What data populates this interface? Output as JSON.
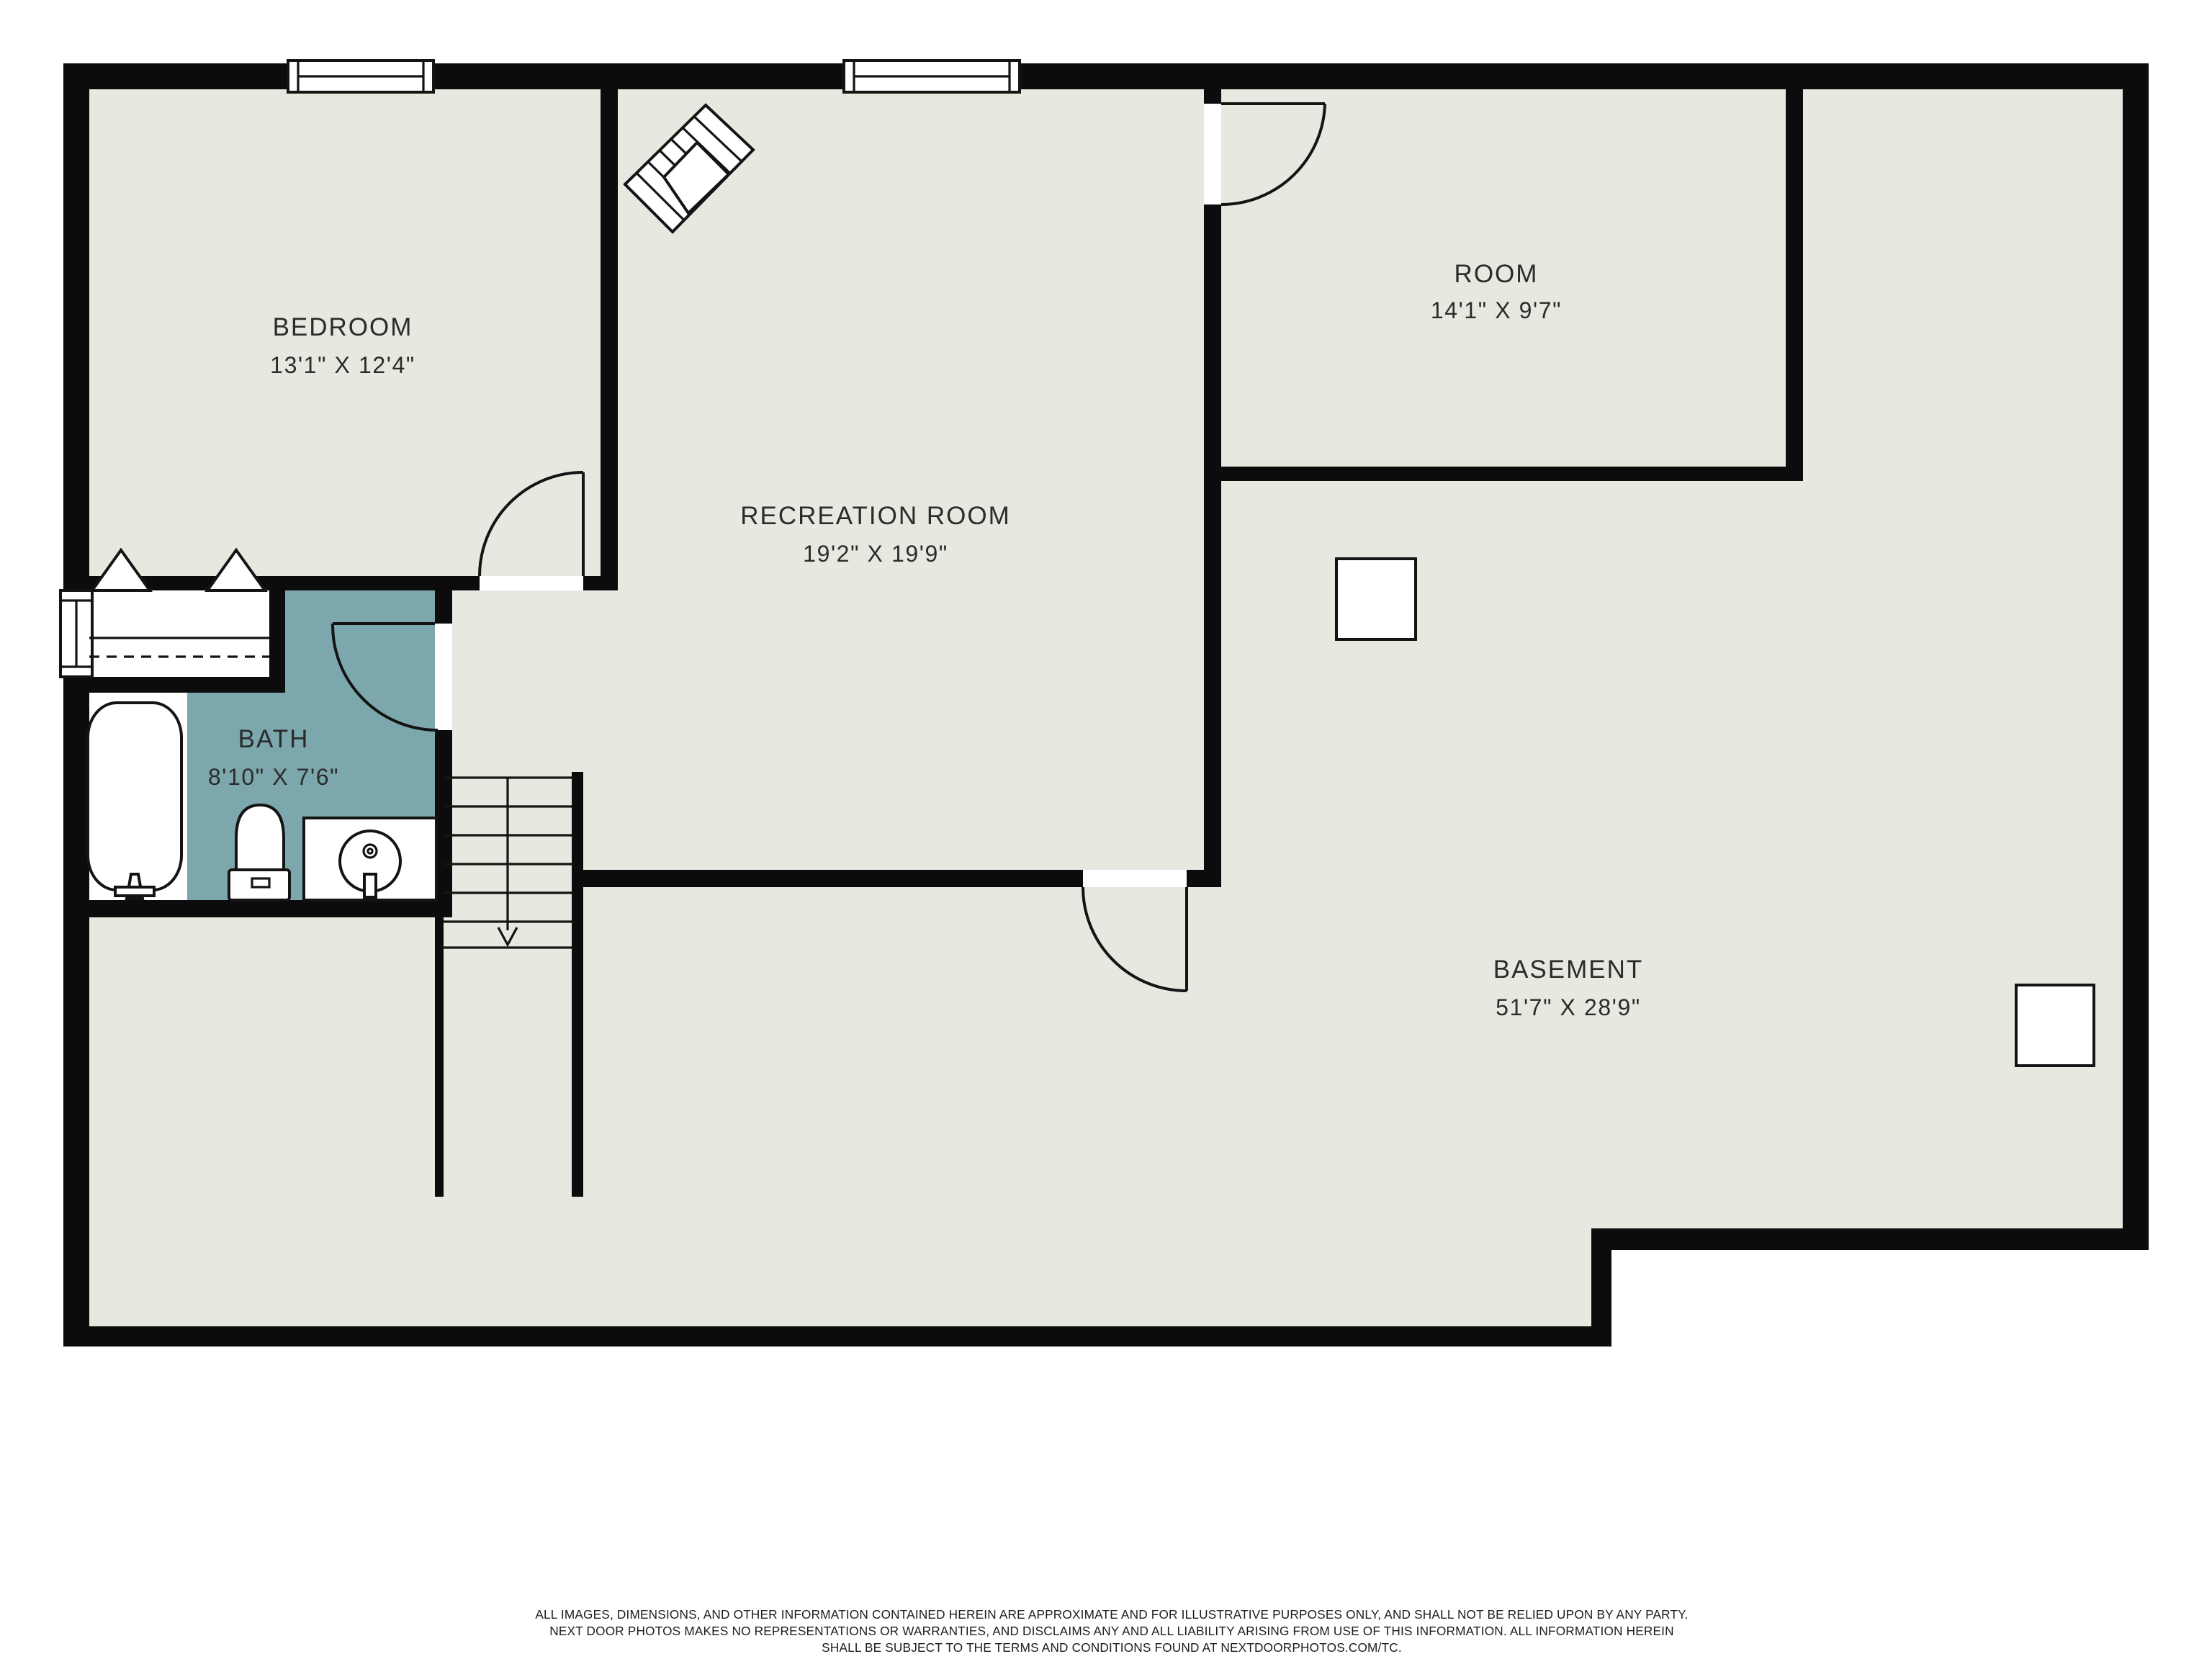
{
  "plan": {
    "rooms": [
      {
        "name": "BEDROOM",
        "dims": "13'1\" X 12'4\""
      },
      {
        "name": "RECREATION ROOM",
        "dims": "19'2\" X 19'9\""
      },
      {
        "name": "ROOM",
        "dims": "14'1\" X 9'7\""
      },
      {
        "name": "BATH",
        "dims": "8'10\" X 7'6\""
      },
      {
        "name": "BASEMENT",
        "dims": "51'7\" X 28'9\""
      }
    ],
    "colors": {
      "floor_fill": "#e8e8e0",
      "bath_fill": "#7ca8ad",
      "wall_color": "#0c0c0c",
      "page_background": "#ffffff",
      "text_color": "#2b2b2b"
    }
  },
  "footer": {
    "line1": "ALL IMAGES, DIMENSIONS, AND OTHER INFORMATION CONTAINED HEREIN ARE APPROXIMATE AND FOR ILLUSTRATIVE PURPOSES ONLY, AND SHALL NOT BE RELIED UPON BY ANY PARTY.",
    "line2": "NEXT DOOR PHOTOS MAKES NO REPRESENTATIONS OR WARRANTIES, AND DISCLAIMS ANY AND ALL LIABILITY ARISING FROM USE OF THIS INFORMATION. ALL INFORMATION HEREIN",
    "line3": "SHALL BE SUBJECT TO THE TERMS AND CONDITIONS FOUND AT NEXTDOORPHOTOS.COM/TC."
  }
}
